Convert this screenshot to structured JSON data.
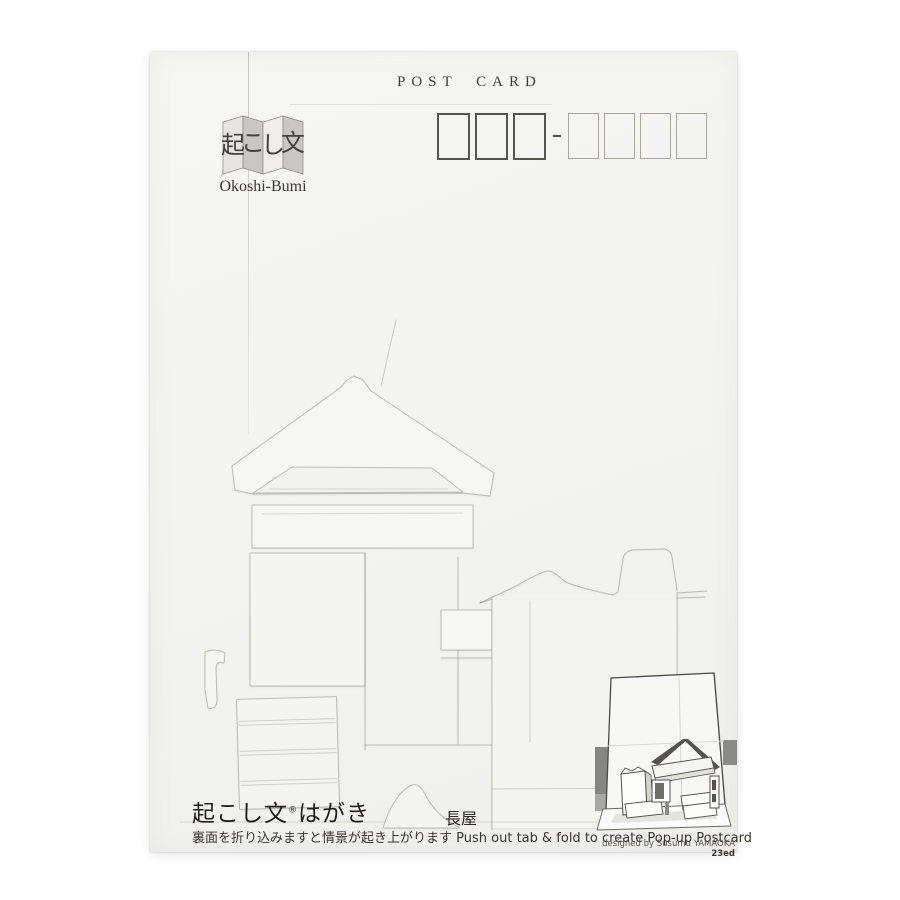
{
  "header": {
    "post_card_label": "POST CARD"
  },
  "postal": {
    "thick_boxes": 3,
    "thin_boxes": 4,
    "separator": "-"
  },
  "logo": {
    "kanji": [
      "起",
      "こ",
      "し",
      "文"
    ],
    "romaji": "Okoshi-Bumi"
  },
  "design": {
    "scene_title": "長屋",
    "embossed_motifs": "gabled roof, eave, signboard, double doors, lantern box, torn wall, shuttered fence, post, mound"
  },
  "footer": {
    "brand": "起こし文",
    "brand_reg": "®",
    "brand_suffix": "はがき",
    "instruction_ja": "裏面を折り込みますと情景が起き上がります",
    "instruction_en": "Push out tab & fold to create Pop-up Postcard",
    "credit": "designed by Susumu YAMAOKA ",
    "edition": "23ed"
  },
  "colors": {
    "card_paper": "#f3f3f0",
    "ink": "#2f2d29",
    "postal_thick_border": "#57554f",
    "postal_thin_border": "#a9a79f",
    "emboss_line": "#7d7a70",
    "illustration_band": "#8a8a88"
  }
}
